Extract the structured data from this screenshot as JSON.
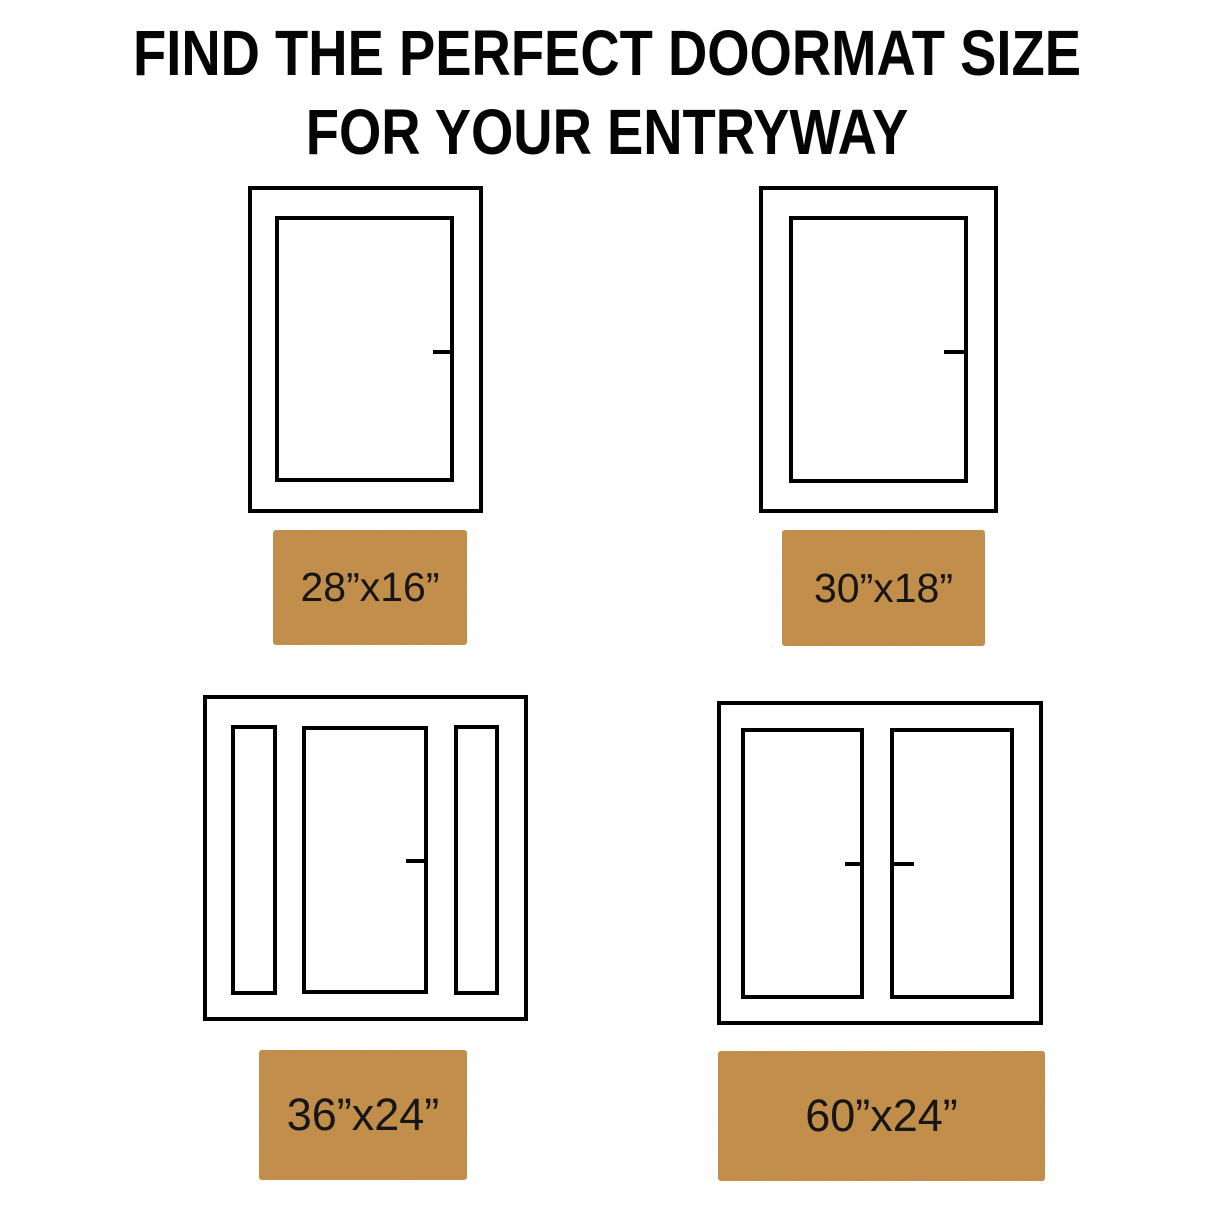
{
  "title": {
    "line1": "FIND THE PERFECT DOORMAT SIZE",
    "line2": "FOR YOUR ENTRYWAY"
  },
  "colors": {
    "background": "#ffffff",
    "line_color": "#000000",
    "mat_color": "#c98e47",
    "mat_speckle": "#8a5a24",
    "mat_label_color": "#161616",
    "title_color": "#050505"
  },
  "sections": [
    {
      "door_type": "single door",
      "mat_size": "28”x16”"
    },
    {
      "door_type": "single door",
      "mat_size": "30”x18”"
    },
    {
      "door_type": "door with sidelights",
      "mat_size": "36”x24”"
    },
    {
      "door_type": "double door",
      "mat_size": "60”x24”"
    }
  ]
}
